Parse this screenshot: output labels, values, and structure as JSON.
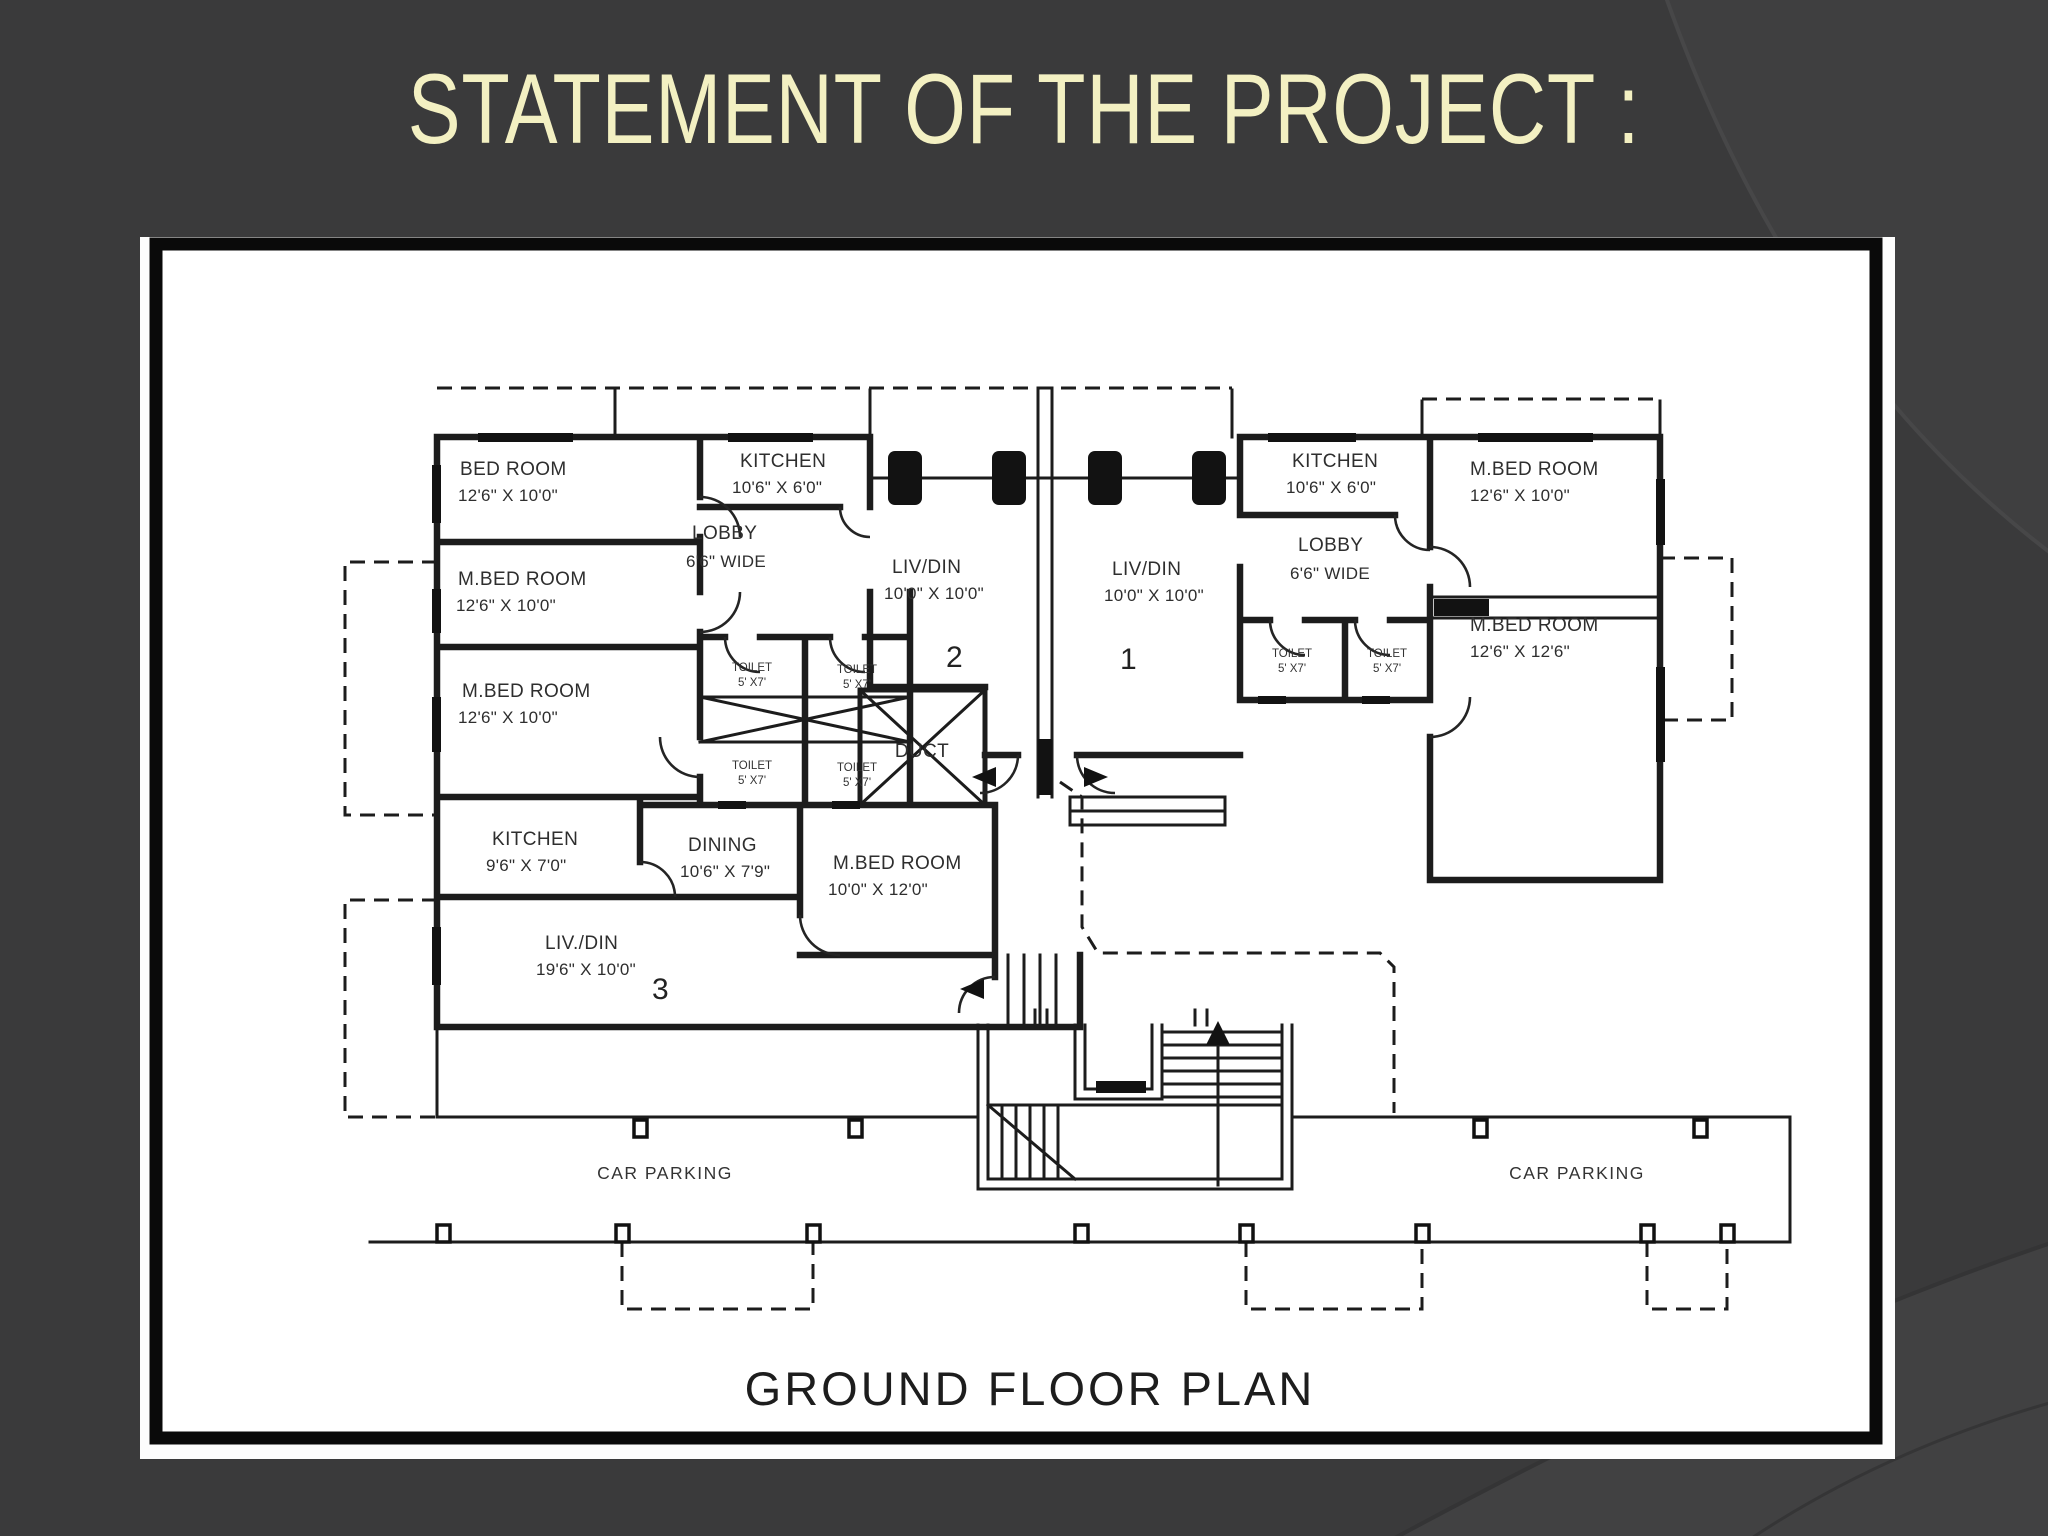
{
  "slide": {
    "title": "STATEMENT OF THE PROJECT :",
    "background_color": "#3a3a3b",
    "title_color": "#f3f0c2"
  },
  "floor_plan": {
    "caption": "GROUND FLOOR PLAN",
    "ink_color": "#1c1c1c",
    "paper_color": "#fdfdfd",
    "flats": {
      "one": "1",
      "two": "2",
      "three": "3"
    },
    "rooms": {
      "bed_room": {
        "name": "BED ROOM",
        "dims": "12'6\" X 10'0\""
      },
      "kitchen_unit2": {
        "name": "KITCHEN",
        "dims": "10'6\" X 6'0\""
      },
      "lobby_unit2": {
        "name": "LOBBY",
        "dims": "6'6\" WIDE"
      },
      "livdin_unit2": {
        "name": "LIV/DIN",
        "dims": "10'0\" X 10'0\""
      },
      "livdin_unit1": {
        "name": "LIV/DIN",
        "dims": "10'0\" X 10'0\""
      },
      "lobby_unit1": {
        "name": "LOBBY",
        "dims": "6'6\" WIDE"
      },
      "kitchen_unit1": {
        "name": "KITCHEN",
        "dims": "10'6\" X 6'0\""
      },
      "mbed_unit1_top": {
        "name": "M.BED ROOM",
        "dims": "12'6\" X 10'0\""
      },
      "mbed_unit1_bot": {
        "name": "M.BED ROOM",
        "dims": "12'6\" X 12'6\""
      },
      "mbed_unit2_a": {
        "name": "M.BED ROOM",
        "dims": "12'6\" X 10'0\""
      },
      "mbed_unit2_b": {
        "name": "M.BED ROOM",
        "dims": "12'6\" X 10'0\""
      },
      "toilet": {
        "name": "TOILET",
        "dims": "5' X7'"
      },
      "duct": {
        "name": "DUCT"
      },
      "kitchen_unit3": {
        "name": "KITCHEN",
        "dims": "9'6\" X 7'0\""
      },
      "dining_unit3": {
        "name": "DINING",
        "dims": "10'6\" X 7'9\""
      },
      "mbed_unit3": {
        "name": "M.BED ROOM",
        "dims": "10'0\" X 12'0\""
      },
      "livdin_unit3": {
        "name": "LIV./DIN",
        "dims": "19'6\" X 10'0\""
      },
      "car_parking": {
        "name": "CAR PARKING"
      }
    }
  }
}
